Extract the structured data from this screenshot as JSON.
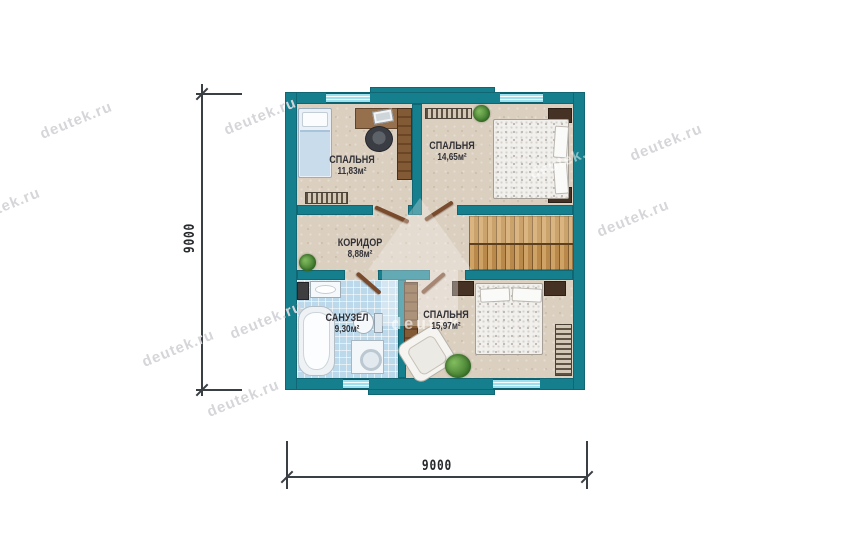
{
  "rooms": [
    {
      "name": "СПАЛЬНЯ",
      "area": "11,83м²"
    },
    {
      "name": "СПАЛЬНЯ",
      "area": "14,65м²"
    },
    {
      "name": "КОРИДОР",
      "area": "8,88м²"
    },
    {
      "name": "САНУЗЕЛ",
      "area": "9,30м²"
    },
    {
      "name": "СПАЛЬНЯ",
      "area": "15,97м²"
    }
  ],
  "dimensions": {
    "width": "9000",
    "height": "9000"
  },
  "watermark": {
    "text": "deutek.ru",
    "logo_text": "deutek"
  },
  "colors": {
    "wall": "#157f8d",
    "floor": "#dbcfc0",
    "tile": "#bcd9ec",
    "window_glass": "#9fe0ef",
    "stair_wood": "#c09a5e",
    "dim_line": "#3a3f44"
  }
}
